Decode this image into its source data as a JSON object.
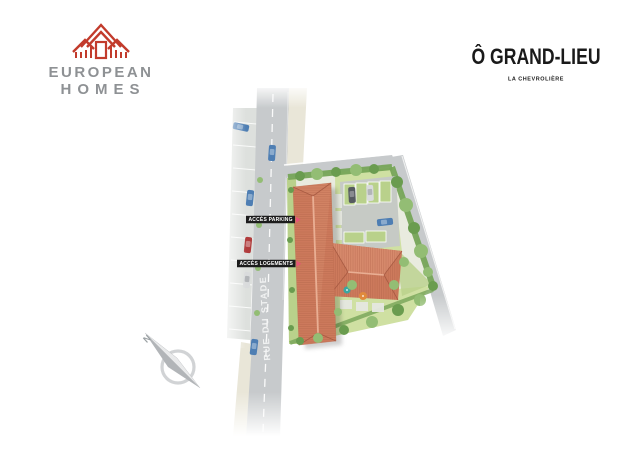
{
  "header": {
    "logo": {
      "line1": "EUROPEAN",
      "line2": "HOMES",
      "icon": "european-homes-house-icon"
    },
    "title": "Ô GRAND-LIEU",
    "subtitle": "LA CHEVROLIÈRE"
  },
  "plan": {
    "road_name": "RUE DU STADE",
    "labels": {
      "parking": "ACCÈS PARKING",
      "housing": "ACCÈS LOGEMENTS"
    },
    "compass_letter": "N",
    "icons": [
      "north-compass-icon",
      "access-arrow-icon"
    ]
  },
  "colors": {
    "brand": "#c23b2c",
    "logoText": "#8e9194",
    "titleText": "#1a1a1a",
    "accent": "#e8537a",
    "labelBg": "#1c1c1c",
    "labelText": "#ffffff",
    "roadText": "#f4f5f5",
    "roof": "#cd7a5c",
    "roofLight": "#d78a6c",
    "roofDark": "#bd6a4e",
    "ridge": "#e9ae93",
    "hipLine": "#a2553e",
    "grass": "#cfe0a2",
    "grassDark": "#b9d18b",
    "hedge": "#76a457",
    "tree": "#6a9c4f",
    "treeLight": "#93bd74",
    "road": "#c7cacc",
    "sidewalk": "#e9e6d8",
    "parkBay": "#dde0dd",
    "asphalt": "#c6cac5",
    "carBlue": "#4e7eb3",
    "carRed": "#b03c3c",
    "carSilver": "#d9dbdc",
    "carDark": "#565b60",
    "compassRing": "#c6c8ca",
    "needleDark": "#b2b5b8",
    "needleLight": "#e9eaeb",
    "terrace": "#e6e8e1",
    "parasolTeal": "#3aa6a0",
    "parasolOrange": "#e08a3c"
  }
}
